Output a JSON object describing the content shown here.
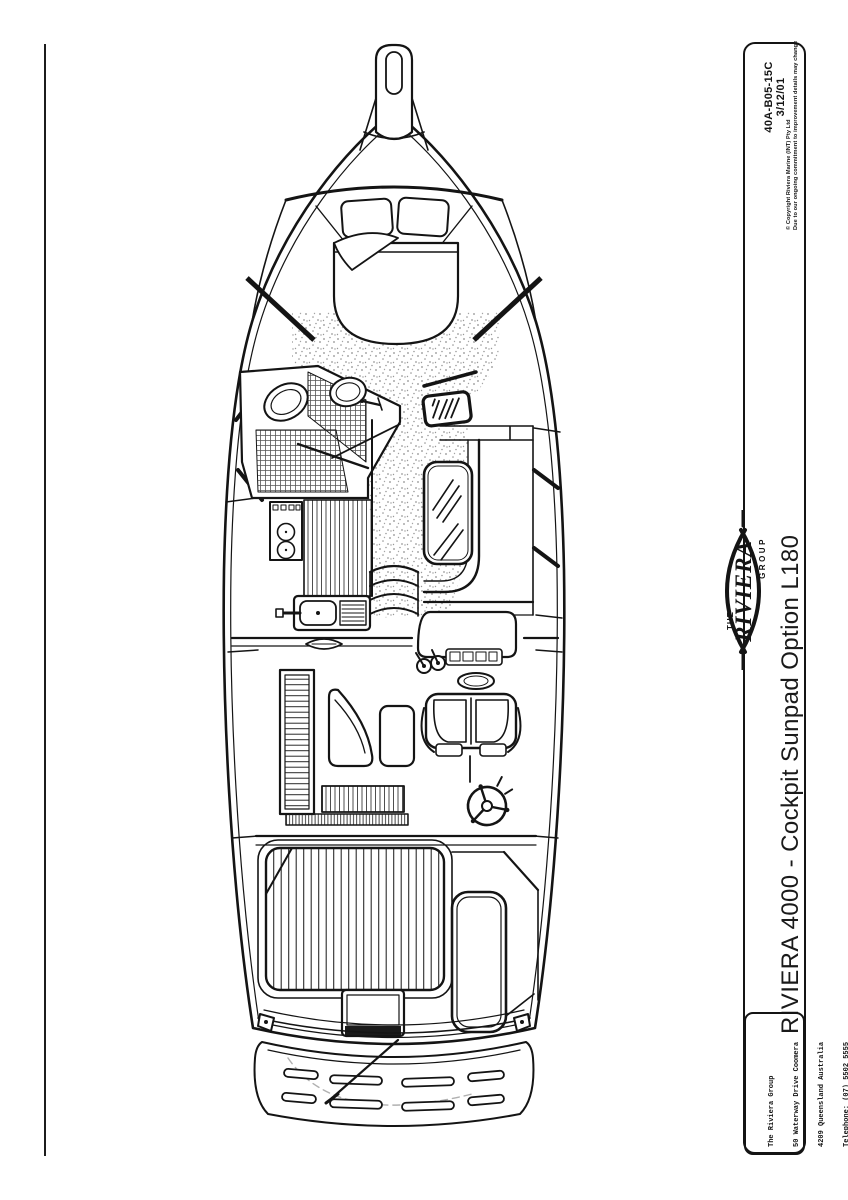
{
  "title_block": {
    "drawing_number": "40A-B05-15C",
    "drawing_date": "3/12/01",
    "copyright_line1": "© Copyright Riviera Marine (INT) Pty Ltd",
    "copyright_line2": "Due to our ongoing commitment to improvement details may change",
    "logo": {
      "the": "THE",
      "riviera": "RIVIERA",
      "group": "GROUP"
    },
    "title": "RIVIERA 4000 - Cockpit Sunpad Option L180",
    "contact": {
      "lines": [
        "The Riviera Group",
        "50 Waterway Drive Coomera",
        "4209 Queensland Australia",
        "Telephone: (07) 5502 5555",
        "Facsimile: (07) 5502 5599",
        "Net:  www.riviera.com.au"
      ]
    }
  },
  "diagram": {
    "subject": "Riviera 4000 overhead deck plan with cockpit sunpad option",
    "line_color": "#141414",
    "stipple_color": "#8f8f8f"
  }
}
